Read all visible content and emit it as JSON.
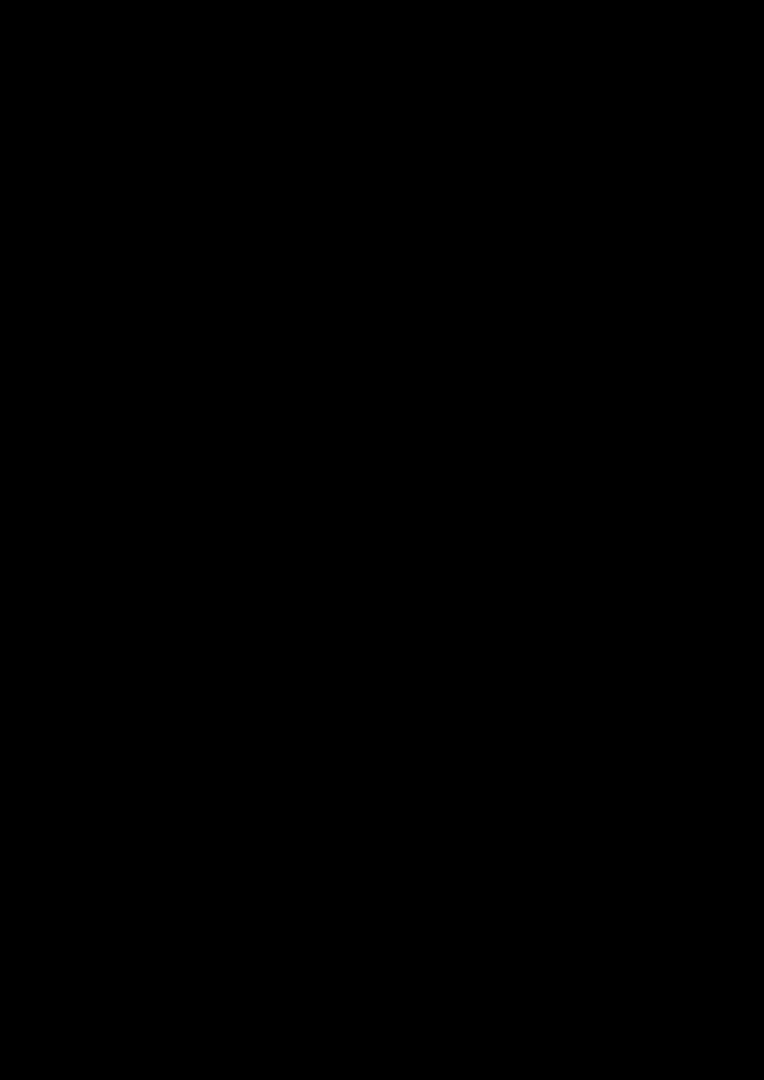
{
  "scene": {
    "type": "3d-floor-plan-render",
    "background": "#000000",
    "canvas": {
      "width": 764,
      "height": 1080
    },
    "fit": {
      "x": 15,
      "y": 288,
      "w": 734,
      "h": 514
    }
  },
  "palette": {
    "background": "#000000",
    "wall_cap": "#323232",
    "closet_cap": "#3e3e3e",
    "niche_cap": "#454545",
    "wall_face_base": 236,
    "wall_face_gain": 19,
    "block_face_base": 220,
    "block_face_gain": 16,
    "glass_bright": "#cfbb93",
    "glass_dark": "#c2ae85",
    "floor_tan": "#d5c09b",
    "floor_tan_balcony": "#d2bd97",
    "floor_gray": "#c9d1d8",
    "floor_gray_bath": "#ccd4da",
    "tub_white": "#fafafa",
    "tub_inner": "#dde4e9",
    "meter_box_red": "#7c3434",
    "window_glass_tan": "#cdb98f",
    "window_glass_pale": "#e7ecf0",
    "window_glass_dark": "#44474a"
  },
  "projection": {
    "kx": 0.707,
    "ky": 0.509,
    "wall_height": 90,
    "camera": [
      -0.451,
      0.893
    ],
    "visibility_threshold": 0.03
  },
  "frames": {
    "L": {
      "ox": 0,
      "oy": 0,
      "xx": 1,
      "xy": 0,
      "yx": 0,
      "yy": 1
    },
    "R": {
      "ox": 536,
      "oy": 346,
      "xx": 0.978,
      "xy": 0.208,
      "yx": 0.208,
      "yy": -0.978
    }
  },
  "elements": [
    {
      "n": "wall-nw-living",
      "f": "L",
      "k": "prism",
      "r": [
        -16,
        -16,
        536,
        0
      ]
    },
    {
      "n": "wall-notch-step",
      "f": "L",
      "k": "prism",
      "r": [
        536,
        -16,
        554,
        100
      ]
    },
    {
      "n": "wall-living-hall",
      "f": "L",
      "k": "prism",
      "r": [
        520,
        -16,
        536,
        160
      ]
    },
    {
      "n": "window-living-big",
      "f": "L",
      "k": "decal",
      "a": [
        519,
        6
      ],
      "b": [
        519,
        154
      ],
      "z0": 4,
      "z1": 88,
      "panels": [
        {
          "u": [
            0,
            1
          ],
          "v": [
            0,
            1
          ],
          "c": "#f7f7f7"
        },
        {
          "u": [
            0.06,
            0.94
          ],
          "v": [
            0.07,
            0.93
          ],
          "c": "#cdb98f"
        },
        {
          "u": [
            0.06,
            0.94
          ],
          "v": [
            0.43,
            0.5
          ],
          "c": "#f7f7f7"
        },
        {
          "u": [
            0.465,
            0.535
          ],
          "v": [
            0.07,
            0.93
          ],
          "c": "#f7f7f7"
        }
      ]
    },
    {
      "n": "wall-nw-hall-bath",
      "f": "R",
      "k": "prism",
      "r": [
        -30,
        220,
        455,
        236
      ]
    },
    {
      "n": "window-hall-inner",
      "f": "R",
      "k": "decal",
      "a": [
        40,
        219
      ],
      "b": [
        110,
        219
      ],
      "z0": 24,
      "z1": 84,
      "panels": [
        {
          "u": [
            0,
            1
          ],
          "v": [
            0,
            1
          ],
          "c": "#f2f2f2"
        },
        {
          "u": [
            0.07,
            0.93
          ],
          "v": [
            0.1,
            0.88
          ],
          "c": "#e7ecf0"
        }
      ]
    },
    {
      "n": "wall-bath-chamfer",
      "f": "R",
      "k": "prism",
      "p": [
        [
          439,
          220
        ],
        [
          484,
          175
        ],
        [
          500,
          191
        ],
        [
          455,
          236
        ]
      ]
    },
    {
      "n": "wall-bath-ne",
      "f": "R",
      "k": "prism",
      "r": [
        484,
        0,
        500,
        175
      ]
    },
    {
      "n": "wall-nw-entry",
      "f": "L",
      "k": "prism",
      "r": [
        -296,
        149,
        0,
        165
      ]
    },
    {
      "n": "floor-living-room",
      "f": "L",
      "k": "floor",
      "r": [
        0,
        0,
        520,
        330
      ],
      "c": "#d5c09b"
    },
    {
      "n": "floor-passage",
      "f": "L",
      "k": "floor",
      "p": [
        [
          436,
          270
        ],
        [
          520,
          270
        ],
        [
          520,
          160
        ],
        [
          536,
          160
        ],
        [
          536,
          330
        ],
        [
          436,
          330
        ]
      ],
      "c": "#c9d1d8"
    },
    {
      "n": "floor-entry-hall",
      "f": "L",
      "k": "floor",
      "r": [
        -150,
        165,
        0,
        330
      ],
      "c": "#d5c09b"
    },
    {
      "n": "floor-balcony",
      "f": "L",
      "k": "floor",
      "r": [
        -280,
        165,
        -150,
        330
      ],
      "c": "#d2bd97"
    },
    {
      "n": "floor-hallway",
      "f": "R",
      "k": "floor",
      "r": [
        0,
        16,
        270,
        220
      ],
      "c": "#c9d1d8"
    },
    {
      "n": "floor-doorway",
      "f": "R",
      "k": "floor",
      "r": [
        270,
        100,
        286,
        190
      ],
      "c": "#c9d1d8"
    },
    {
      "n": "floor-bathroom",
      "f": "R",
      "k": "floor",
      "p": [
        [
          286,
          16
        ],
        [
          484,
          16
        ],
        [
          484,
          175
        ],
        [
          439,
          220
        ],
        [
          286,
          220
        ]
      ],
      "c": "#ccd4da"
    },
    {
      "n": "bathtub-rim",
      "f": "R",
      "k": "prism",
      "r": [
        320,
        64,
        400,
        204
      ],
      "z1": 22,
      "tone": "#fafafa",
      "cap": "#fcfcfc"
    },
    {
      "n": "bathtub-inner",
      "f": "R",
      "k": "floor",
      "r": [
        328,
        72,
        392,
        196
      ],
      "z": 16,
      "c": "#dde4e9"
    },
    {
      "n": "bathroom-door-leaf",
      "f": "R",
      "k": "prism",
      "r": [
        290,
        102,
        296,
        188
      ],
      "z1": 74,
      "tone": "#f4f4f4",
      "cap": "#efefef"
    },
    {
      "n": "wall-hall-bath-a",
      "f": "R",
      "k": "prism",
      "r": [
        270,
        16,
        286,
        100
      ]
    },
    {
      "n": "wall-hall-bath-b",
      "f": "R",
      "k": "prism",
      "r": [
        270,
        190,
        286,
        220
      ]
    },
    {
      "n": "closet-wall-n1",
      "f": "L",
      "k": "prism",
      "r": [
        370,
        140,
        385,
        150
      ],
      "tone": "block",
      "cap": "#3e3e3e"
    },
    {
      "n": "closet-wall-n2",
      "f": "L",
      "k": "prism",
      "r": [
        440,
        140,
        455,
        150
      ],
      "tone": "block",
      "cap": "#3e3e3e"
    },
    {
      "n": "closet-wall-n3",
      "f": "L",
      "k": "prism",
      "r": [
        510,
        140,
        520,
        150
      ],
      "tone": "block",
      "cap": "#3e3e3e"
    },
    {
      "n": "closet-wall-w",
      "f": "L",
      "k": "prism",
      "r": [
        370,
        150,
        380,
        280
      ],
      "tone": "block",
      "cap": "#3e3e3e"
    },
    {
      "n": "closet-wall-mid",
      "f": "L",
      "k": "prism",
      "r": [
        445,
        150,
        455,
        280
      ],
      "tone": "block",
      "cap": "#3e3e3e"
    },
    {
      "n": "closet-wall-e",
      "f": "L",
      "k": "prism",
      "r": [
        510,
        150,
        520,
        280
      ],
      "tone": "block",
      "cap": "#3e3e3e"
    },
    {
      "n": "closet-wall-s",
      "f": "L",
      "k": "prism",
      "r": [
        370,
        270,
        520,
        280
      ],
      "tone": "block",
      "cap": "#3e3e3e"
    },
    {
      "n": "closet-door-leaf",
      "f": "L",
      "k": "prism",
      "r": [
        386,
        152,
        391,
        222
      ],
      "z1": 74,
      "tone": "#f6f6f6",
      "cap": "#f0f0f0"
    },
    {
      "n": "wall-west-a",
      "f": "L",
      "k": "prism",
      "r": [
        -16,
        -16,
        0,
        185
      ]
    },
    {
      "n": "wall-west-b",
      "f": "L",
      "k": "prism",
      "r": [
        -16,
        250,
        0,
        346
      ]
    },
    {
      "n": "entry-door-leaf",
      "f": "L",
      "k": "prism",
      "r": [
        -12,
        185,
        -4,
        250
      ],
      "z1": 80,
      "tone": "#f7f7f7",
      "cap": "#f1f1f1"
    },
    {
      "n": "entry-door-panel",
      "f": "L",
      "k": "decal",
      "a": [
        -13,
        250
      ],
      "b": [
        -13,
        185
      ],
      "z0": 2,
      "z1": 78,
      "panels": [
        {
          "u": [
            0,
            1
          ],
          "v": [
            0,
            1
          ],
          "c": "#fbfbfb"
        },
        {
          "u": [
            0.12,
            0.88
          ],
          "v": [
            0.08,
            0.92
          ],
          "c": "#f4f4f4"
        },
        {
          "u": [
            0.15,
            0.24
          ],
          "v": [
            0.47,
            0.55
          ],
          "c": "#9aa0a5"
        }
      ]
    },
    {
      "n": "meter-closet-wall-w",
      "f": "L",
      "k": "prism",
      "r": [
        -80,
        165,
        -72,
        214
      ],
      "z1": 52,
      "cap": "#454545"
    },
    {
      "n": "meter-closet-wall-e",
      "f": "L",
      "k": "prism",
      "r": [
        -32,
        165,
        -24,
        214
      ],
      "z1": 52,
      "cap": "#454545"
    },
    {
      "n": "meter-closet-wall-s",
      "f": "L",
      "k": "prism",
      "r": [
        -80,
        206,
        -24,
        214
      ],
      "z1": 52,
      "cap": "#454545"
    },
    {
      "n": "meter-box",
      "f": "L",
      "k": "prism",
      "r": [
        -70,
        168,
        -36,
        204
      ],
      "z1": 40,
      "tone": "#eeeae9",
      "cap": "#7c3434"
    },
    {
      "n": "balcony-glass-door",
      "f": "L",
      "k": "prism",
      "r": [
        -150,
        165,
        -142,
        330
      ],
      "tone": "glass",
      "cap": "#3a3a3a"
    },
    {
      "n": "balcony-glass-door-frame",
      "f": "L",
      "k": "decal",
      "a": [
        -151,
        165
      ],
      "b": [
        -151,
        330
      ],
      "z0": 0,
      "z1": 88,
      "panels": [
        {
          "u": [
            0,
            1
          ],
          "v": [
            0,
            0.07
          ],
          "c": "#f0f0f0"
        },
        {
          "u": [
            0,
            0.05
          ],
          "v": [
            0,
            1
          ],
          "c": "#f0f0f0"
        },
        {
          "u": [
            0.95,
            1
          ],
          "v": [
            0,
            1
          ],
          "c": "#f0f0f0"
        },
        {
          "u": [
            0.46,
            0.54
          ],
          "v": [
            0,
            1
          ],
          "c": "#eeeeee"
        }
      ]
    },
    {
      "n": "glass-wall-sw",
      "f": "L",
      "k": "prism",
      "r": [
        -296,
        165,
        -280,
        346
      ],
      "tone": "glass",
      "cap": "#323232"
    },
    {
      "n": "glass-wall-sw-mullions",
      "f": "L",
      "k": "decal",
      "a": [
        -297,
        165
      ],
      "b": [
        -297,
        346
      ],
      "z0": 0,
      "z1": 90,
      "panels": [
        {
          "u": [
            0,
            1
          ],
          "v": [
            0,
            0.08
          ],
          "c": "#efefef"
        },
        {
          "u": [
            0.3,
            0.35
          ],
          "v": [
            0,
            1
          ],
          "c": "#efefef"
        },
        {
          "u": [
            0.64,
            0.69
          ],
          "v": [
            0,
            1
          ],
          "c": "#efefef"
        },
        {
          "u": [
            0,
            1
          ],
          "v": [
            0.9,
            1
          ],
          "c": "#e8e8e8"
        }
      ]
    },
    {
      "n": "glass-facade-se",
      "f": "L",
      "k": "prism",
      "r": [
        -280,
        330,
        0,
        346
      ],
      "tone": "glass",
      "cap": "#323232"
    },
    {
      "n": "glass-facade-se-mullions",
      "f": "L",
      "k": "decal",
      "a": [
        -280,
        347
      ],
      "b": [
        0,
        347
      ],
      "z0": 0,
      "z1": 90,
      "panels": [
        {
          "u": [
            0,
            1
          ],
          "v": [
            0,
            0.07
          ],
          "c": "#f1f1f1"
        },
        {
          "u": [
            0,
            1
          ],
          "v": [
            0.91,
            1
          ],
          "c": "#eaeaea"
        },
        {
          "u": [
            0,
            0.03
          ],
          "v": [
            0,
            1
          ],
          "c": "#f1f1f1"
        },
        {
          "u": [
            0.2,
            0.235
          ],
          "v": [
            0,
            1
          ],
          "c": "#f1f1f1"
        },
        {
          "u": [
            0.4,
            0.43
          ],
          "v": [
            0,
            1
          ],
          "c": "#f4f4f4"
        },
        {
          "u": [
            0.57,
            0.6
          ],
          "v": [
            0,
            1
          ],
          "c": "#f4f4f4"
        },
        {
          "u": [
            0.79,
            0.82
          ],
          "v": [
            0,
            1
          ],
          "c": "#f1f1f1"
        },
        {
          "u": [
            0.97,
            1
          ],
          "v": [
            0,
            1
          ],
          "c": "#f1f1f1"
        }
      ]
    },
    {
      "n": "wall-se-living",
      "f": "L",
      "k": "prism",
      "r": [
        0,
        330,
        536,
        346
      ]
    },
    {
      "n": "window-living-se",
      "f": "L",
      "k": "decal",
      "a": [
        40,
        347
      ],
      "b": [
        215,
        347
      ],
      "z0": 5,
      "z1": 88,
      "panels": [
        {
          "u": [
            0,
            1
          ],
          "v": [
            0,
            1
          ],
          "c": "#f6f6f6"
        },
        {
          "u": [
            0.05,
            0.95
          ],
          "v": [
            0.08,
            0.93
          ],
          "c": "#cbb78d"
        },
        {
          "u": [
            0.05,
            0.95
          ],
          "v": [
            0.42,
            0.49
          ],
          "c": "#f6f6f6"
        },
        {
          "u": [
            0.33,
            0.37
          ],
          "v": [
            0.08,
            0.93
          ],
          "c": "#f6f6f6"
        },
        {
          "u": [
            0.63,
            0.67
          ],
          "v": [
            0.08,
            0.93
          ],
          "c": "#f6f6f6"
        }
      ]
    },
    {
      "n": "wall-se-hall-bath",
      "f": "R",
      "k": "prism",
      "r": [
        0,
        0,
        500,
        16
      ]
    },
    {
      "n": "window-bath-se",
      "f": "R",
      "k": "decal",
      "a": [
        295,
        -1
      ],
      "b": [
        385,
        -1
      ],
      "z0": 28,
      "z1": 86,
      "panels": [
        {
          "u": [
            0,
            1
          ],
          "v": [
            0,
            1
          ],
          "c": "#f2f2f2"
        },
        {
          "u": [
            0.06,
            0.94
          ],
          "v": [
            0.08,
            0.55
          ],
          "c": "#44474a"
        },
        {
          "u": [
            0.06,
            0.94
          ],
          "v": [
            0.55,
            0.93
          ],
          "c": "#eff1f2"
        }
      ]
    }
  ]
}
